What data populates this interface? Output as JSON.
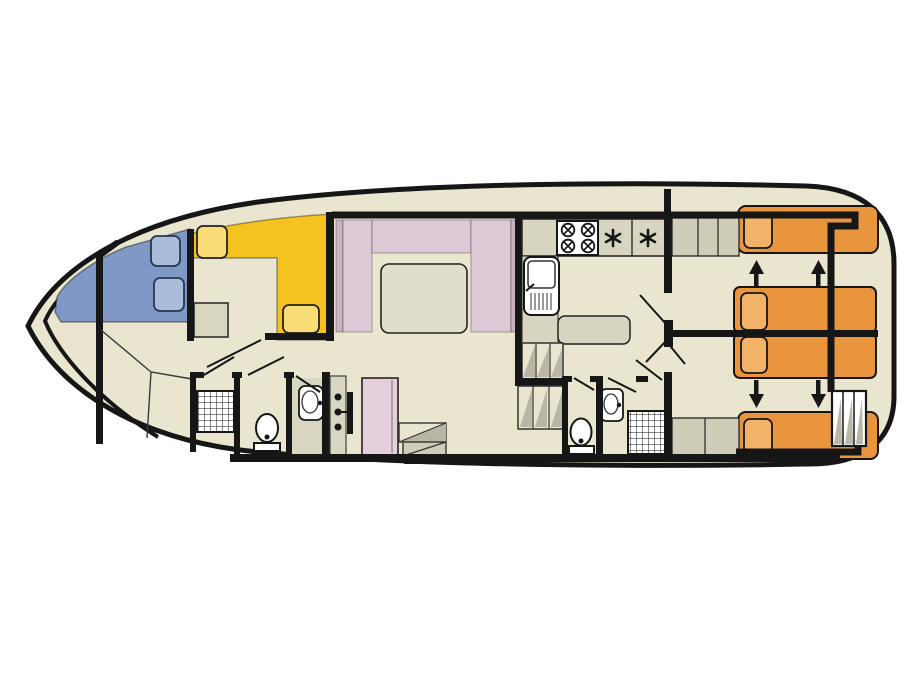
{
  "page": {
    "background": "#ffffff"
  },
  "diagram": {
    "kind": "houseboat-deck-plan-top-view",
    "orientation": "bow-left-stern-right"
  },
  "colors": {
    "floor": "#e9e5cf",
    "wet_floor": "#d8d5c1",
    "counter": "#d7d4bf",
    "counter_dark": "#cfccb8",
    "step_shade": "#b9b6a6",
    "wall": "#161616",
    "yellow_bench": "#f5c21f",
    "yellow_cushion": "#fbdd78",
    "blue_bed": "#7f98c5",
    "blue_pillow": "#a9bcd9",
    "pink_sofa": "#dcc9d5",
    "pink_sofa_edge": "#c9b3c3",
    "pink_wardrobe": "#e6cfdc",
    "saloon_table": "#e0decb",
    "dinette_table": "#d8d5c1",
    "orange_bed": "#e9953e",
    "orange_pillow": "#f2b368",
    "white_fixture": "#ffffff"
  },
  "front_cabin": {
    "double_bed_pillows": 2,
    "dinette_cushions": 2,
    "table_count": 1
  },
  "saloon": {
    "u_sofa_sections": 3,
    "table_count": 1
  },
  "kitchen": {
    "stove_burners": 4,
    "hob_marks": 2,
    "sink_count": 1
  },
  "bathrooms": {
    "forward": {
      "shower": 1,
      "toilet": 1,
      "basin": 1,
      "wardrobe_knobs": 3
    },
    "aft": {
      "shower": 1,
      "toilet": 1,
      "basin": 1
    }
  },
  "aft_cabins": {
    "double_beds": 2,
    "single_beds": 2,
    "slide_arrows_up": 2,
    "slide_arrows_down": 2,
    "stern_ladder_treads": 3
  }
}
